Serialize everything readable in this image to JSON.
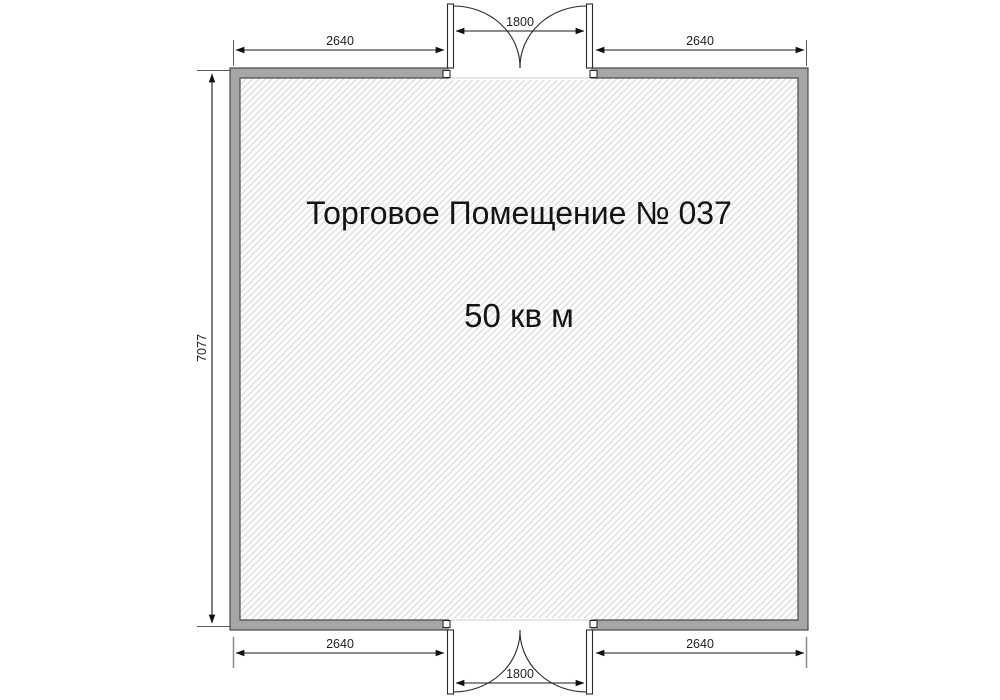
{
  "floorplan": {
    "title": "Торговое Помещение № 037",
    "area_label": "50 кв м",
    "dims": {
      "top_left": "2640",
      "top_center": "1800",
      "top_right": "2640",
      "left": "7077",
      "bottom_left": "2640",
      "bottom_center": "1800",
      "bottom_right": "2640"
    },
    "colors": {
      "wall_fill": "#a6a6a6",
      "wall_outline": "#4d4d4d",
      "floor_fill": "#fcfdfc",
      "hatch_line": "#c9d6c9",
      "dim_line": "#1a1a1a",
      "text": "#141414"
    }
  }
}
